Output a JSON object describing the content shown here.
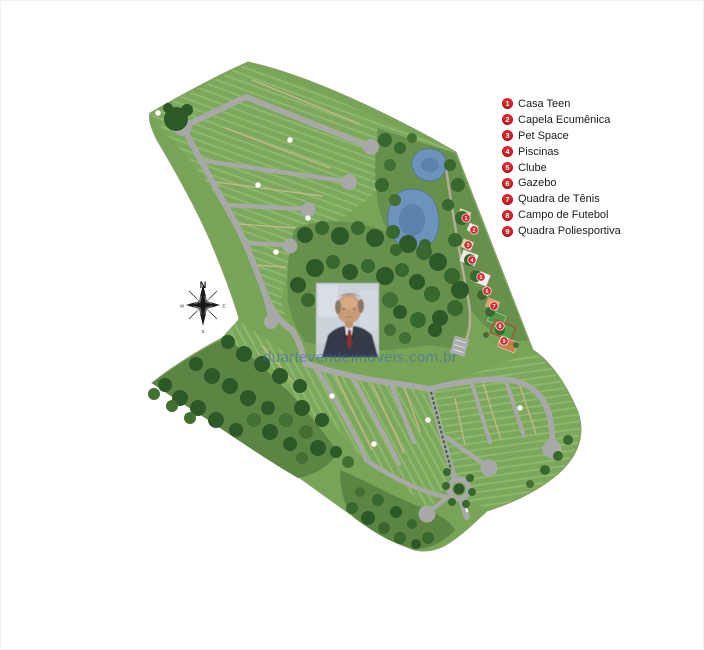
{
  "legend": {
    "items": [
      {
        "number": "1",
        "label": "Casa Teen"
      },
      {
        "number": "2",
        "label": "Capela Ecumênica"
      },
      {
        "number": "3",
        "label": "Pet Space"
      },
      {
        "number": "4",
        "label": "Piscinas"
      },
      {
        "number": "5",
        "label": "Clube"
      },
      {
        "number": "6",
        "label": "Gazebo"
      },
      {
        "number": "7",
        "label": "Quadra de Tênis"
      },
      {
        "number": "8",
        "label": "Campo de Futebol"
      },
      {
        "number": "9",
        "label": "Quadra Poliesportiva"
      }
    ]
  },
  "map": {
    "markers": [
      "1",
      "2",
      "3",
      "4",
      "5",
      "6",
      "7",
      "8",
      "9"
    ],
    "colors": {
      "land_green": "#79a458",
      "forest_green": "#2d5827",
      "road_grey": "#a6a9a6",
      "water_blue": "#6b93bb",
      "marker_red": "#d9252b",
      "watermark_blue": "rgba(58,98,190,0.52)"
    }
  },
  "compass": {
    "north": "N",
    "east": "E",
    "south": "S",
    "west": "W"
  },
  "watermark": {
    "text": "duartevendeimoveis.com.br"
  }
}
